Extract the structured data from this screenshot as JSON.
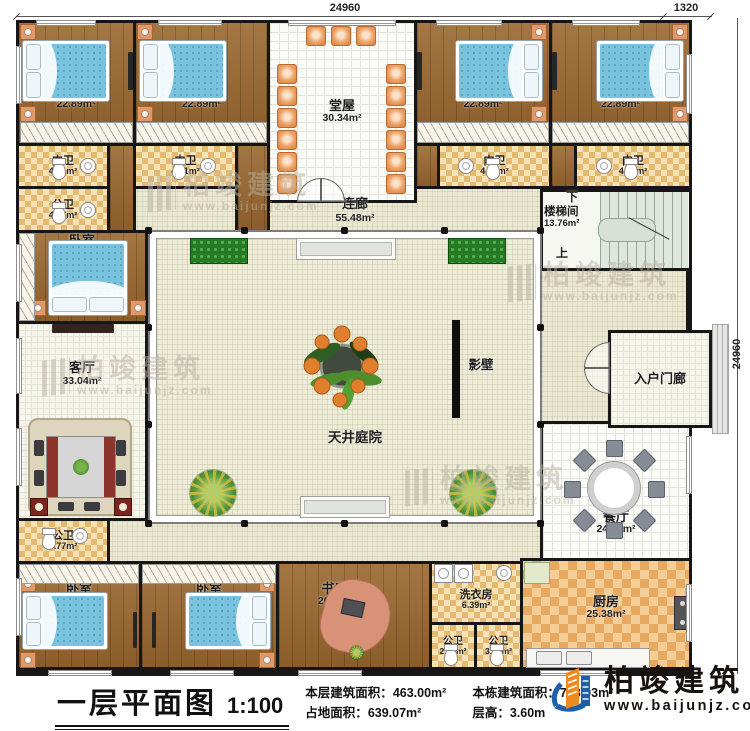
{
  "dimensions": {
    "top": "24960",
    "top_right": "1320",
    "right": "24960"
  },
  "rooms": {
    "br1": {
      "name": "卧室",
      "area": "22.89m²"
    },
    "br2": {
      "name": "卧室",
      "area": "22.89m²"
    },
    "br3": {
      "name": "卧室",
      "area": "22.89m²"
    },
    "br4": {
      "name": "卧室",
      "area": "22.89m²"
    },
    "br5": {
      "name": "卧室",
      "area": "14.79m²"
    },
    "br6": {
      "name": "卧室",
      "area": "19.47m²"
    },
    "br7": {
      "name": "卧室",
      "area": "19.47m²"
    },
    "nw1": {
      "name": "内卫",
      "area": "4.71m²"
    },
    "nw2": {
      "name": "内卫",
      "area": "4.71m²"
    },
    "nw3": {
      "name": "内卫",
      "area": "4.71m²"
    },
    "nw4": {
      "name": "内卫",
      "area": "4.71m²"
    },
    "gw1": {
      "name": "公卫",
      "area": "4.77m²"
    },
    "gw2": {
      "name": "公卫",
      "area": "4.77m²"
    },
    "gw3": {
      "name": "公卫",
      "area": "2.94m²"
    },
    "gw4": {
      "name": "公卫",
      "area": "3.21m²"
    },
    "tangwu": {
      "name": "堂屋",
      "area": "30.34m²"
    },
    "lianlang": {
      "name": "连廊",
      "area": "55.48m²"
    },
    "loutijian": {
      "name": "楼梯间",
      "area": "13.76m²"
    },
    "keting": {
      "name": "客厅",
      "area": "33.04m²"
    },
    "canting": {
      "name": "餐厅",
      "area": "24.62m²"
    },
    "chufang": {
      "name": "厨房",
      "area": "25.38m²"
    },
    "shufang": {
      "name": "书房",
      "area": "20.9m²"
    },
    "xiyifang": {
      "name": "洗衣房",
      "area": "6.39m²"
    },
    "yingbi": {
      "name": "影壁"
    },
    "tianjing": {
      "name": "天井庭院"
    },
    "rumenlang": {
      "name": "入户门廊"
    }
  },
  "stairs": {
    "down": "下",
    "up": "上"
  },
  "titlebar": {
    "title": "一层平面图",
    "scale": "1:100",
    "stats": [
      {
        "label": "本层建筑面积：",
        "value": "463.00m²"
      },
      {
        "label": "占地面积：",
        "value": "639.07m²"
      },
      {
        "label": "本栋建筑面积：",
        "value": "768.93m²"
      },
      {
        "label": "层高：",
        "value": "3.60m"
      }
    ]
  },
  "logo": {
    "name": "柏竣建筑",
    "url": "www.baijunjz.com"
  },
  "watermark": {
    "name": "柏竣建筑",
    "url": "www.baijunjz.com"
  }
}
